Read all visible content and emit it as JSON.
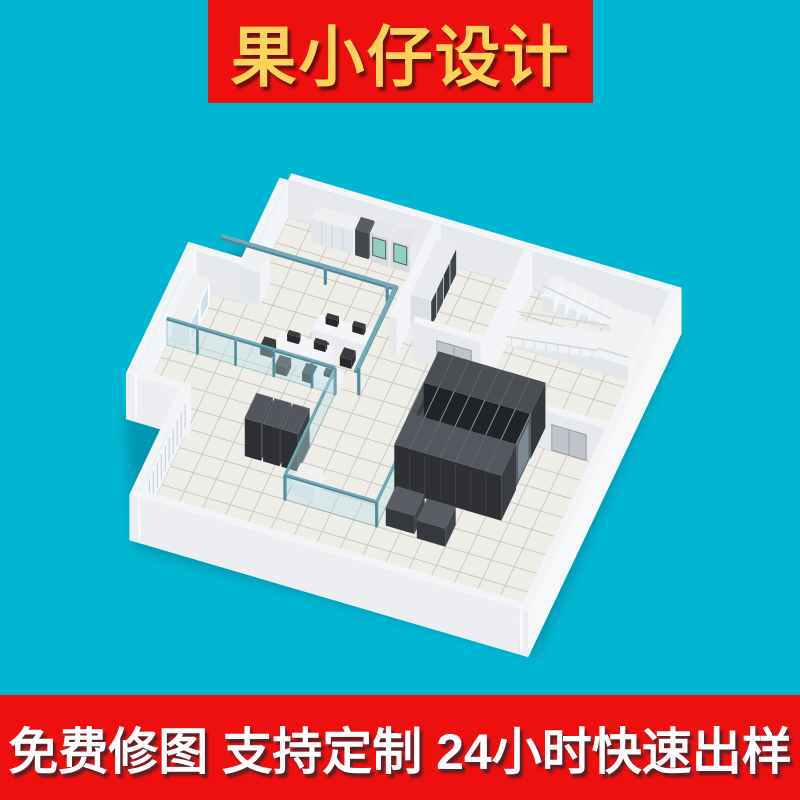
{
  "page": {
    "background_color": "#00b7d3"
  },
  "top_banner": {
    "label": "果小仔设计",
    "background_color": "#ee0f0f",
    "text_color": "#fbd25a"
  },
  "bottom_banner": {
    "label": "免费修图 支持定制 24小时快速出样",
    "background_color": "#ee0f0f",
    "text_color": "#ffffff"
  },
  "floorplan": {
    "palette": {
      "wall_top": "#f3f4f6",
      "wall_inner_left": "#e7e9ed",
      "wall_inner_right": "#f4f5f8",
      "wall_outer_left": "#eceef2",
      "wall_outer_right": "#f7f8fa",
      "floor": "#efede8",
      "floor_grid": "#c9c6c0",
      "rack_front": "#2e3033",
      "rack_side": "#3e4146",
      "rack_top": "#53565c",
      "rack_line": "#6a6e74",
      "roof_glass": "rgba(22,26,30,0.72)",
      "roof_rib": "#8a9199",
      "glass_frame": "#4e8997",
      "glass_panel": "rgba(185,222,228,0.4)",
      "glass_edge": "rgba(110,160,170,0.5)",
      "tray_teal": "#5b93a0",
      "tray_top": "#74aab5",
      "cabinet_top": "#eef0f2",
      "cabinet_front": "#e3e6ea",
      "cabinet_side": "#f2f3f6",
      "cabinet_divider": "#d3d7db",
      "glass_cabinet_pane": "#cfe2ea",
      "green_screen": "#93cfbd",
      "door_gray": "#c0c4ca",
      "door_frame": "#979da5",
      "dark_item": "#26282c",
      "stair_white": "#f1f2f4",
      "railing": "#cfd5da",
      "louver": "#c9cdd3",
      "shadow": "rgba(0,90,110,0.35)"
    }
  }
}
